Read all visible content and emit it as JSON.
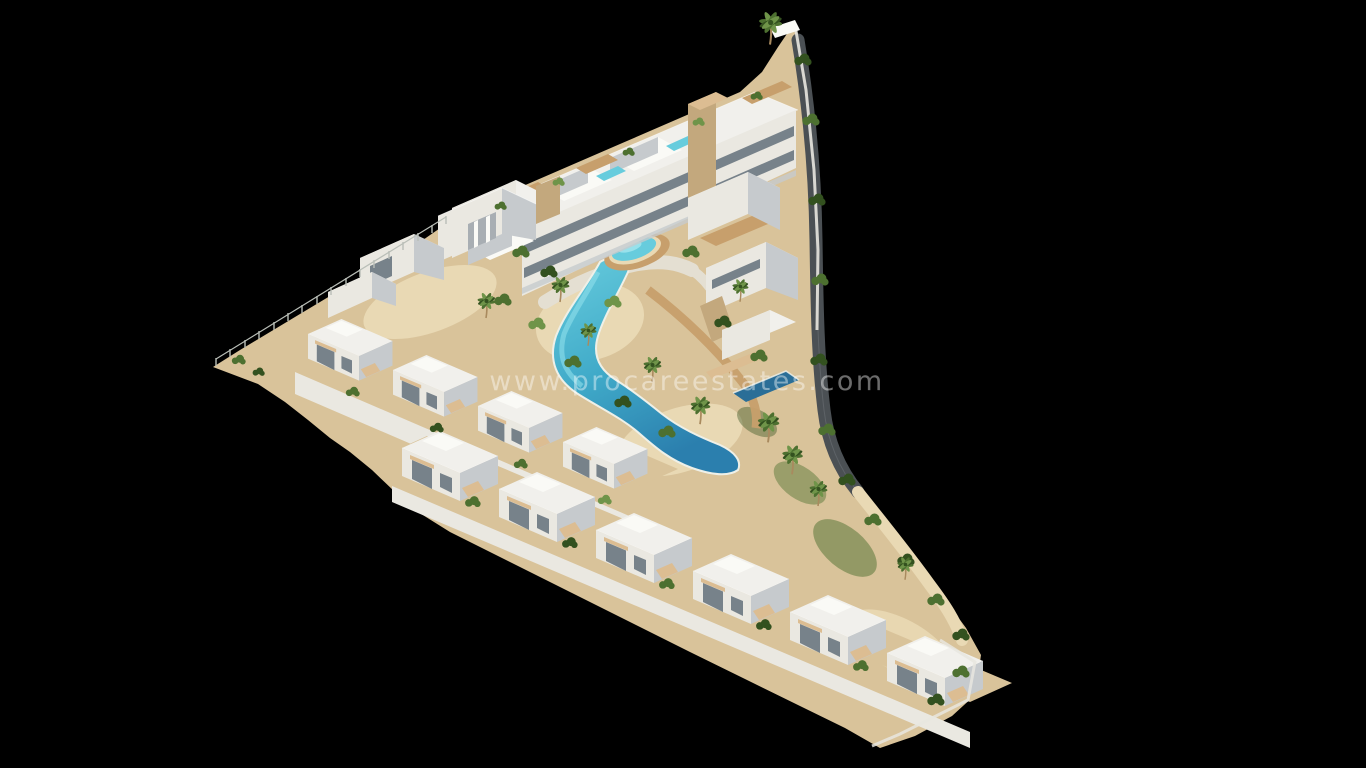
{
  "scene": {
    "type": "3d-architectural-render",
    "subject": "Aerial 3D render of a white Mediterranean residential complex with a winding lagoon pool, apartment block and townhouse rows on a black background",
    "watermark": "www.procareestates.com"
  },
  "colors": {
    "background": "#000000",
    "roof-white": "#f1f0ec",
    "roof-bright": "#fafaf6",
    "wall-bright": "#eae8e1",
    "wall-shade": "#c6cacd",
    "wall-deep": "#a8aeb3",
    "glass": "#77828a",
    "stone": "#c3a87d",
    "wood": "#c79f6c",
    "wood-light": "#dcbd92",
    "sand": "#d9c39a",
    "sand-light": "#e9d9b4",
    "path": "#e4dfd2",
    "pool-light": "#67ccdd",
    "pool-deep": "#2b7fae",
    "pool-dark": "#2a6e97",
    "green-dark": "#33511f",
    "green-mid": "#4d7030",
    "green-light": "#6f9449",
    "road": "#4b5054",
    "fence": "#b9beb7",
    "watermark": "rgba(255,255,255,0.42)"
  }
}
